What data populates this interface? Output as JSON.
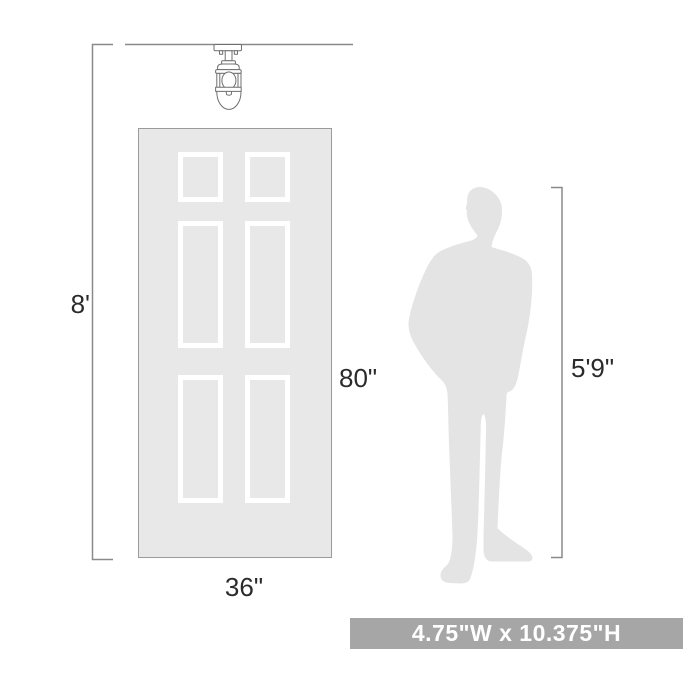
{
  "diagram": {
    "ceiling_height_label": "8'",
    "door_height_label": "80\"",
    "door_width_label": "36\"",
    "person_height_label": "5'9\"",
    "banner_label": "4.75\"W x 10.375\"H"
  },
  "illustrations": {
    "fixture": "semi-flush-cage-ceiling-light",
    "door": "six-panel-door",
    "person": "standing-man-silhouette"
  },
  "colors": {
    "background": "#ffffff",
    "line": "#8a8a8a",
    "label_text": "#2b2b2b",
    "door_fill": "#e8e8e8",
    "door_border": "#9b9b9b",
    "panel_frame": "#ffffff",
    "silhouette": "#e4e4e4",
    "fixture_stroke": "#6f6f6f",
    "banner_bg": "#a6a6a6",
    "banner_text": "#ffffff"
  }
}
